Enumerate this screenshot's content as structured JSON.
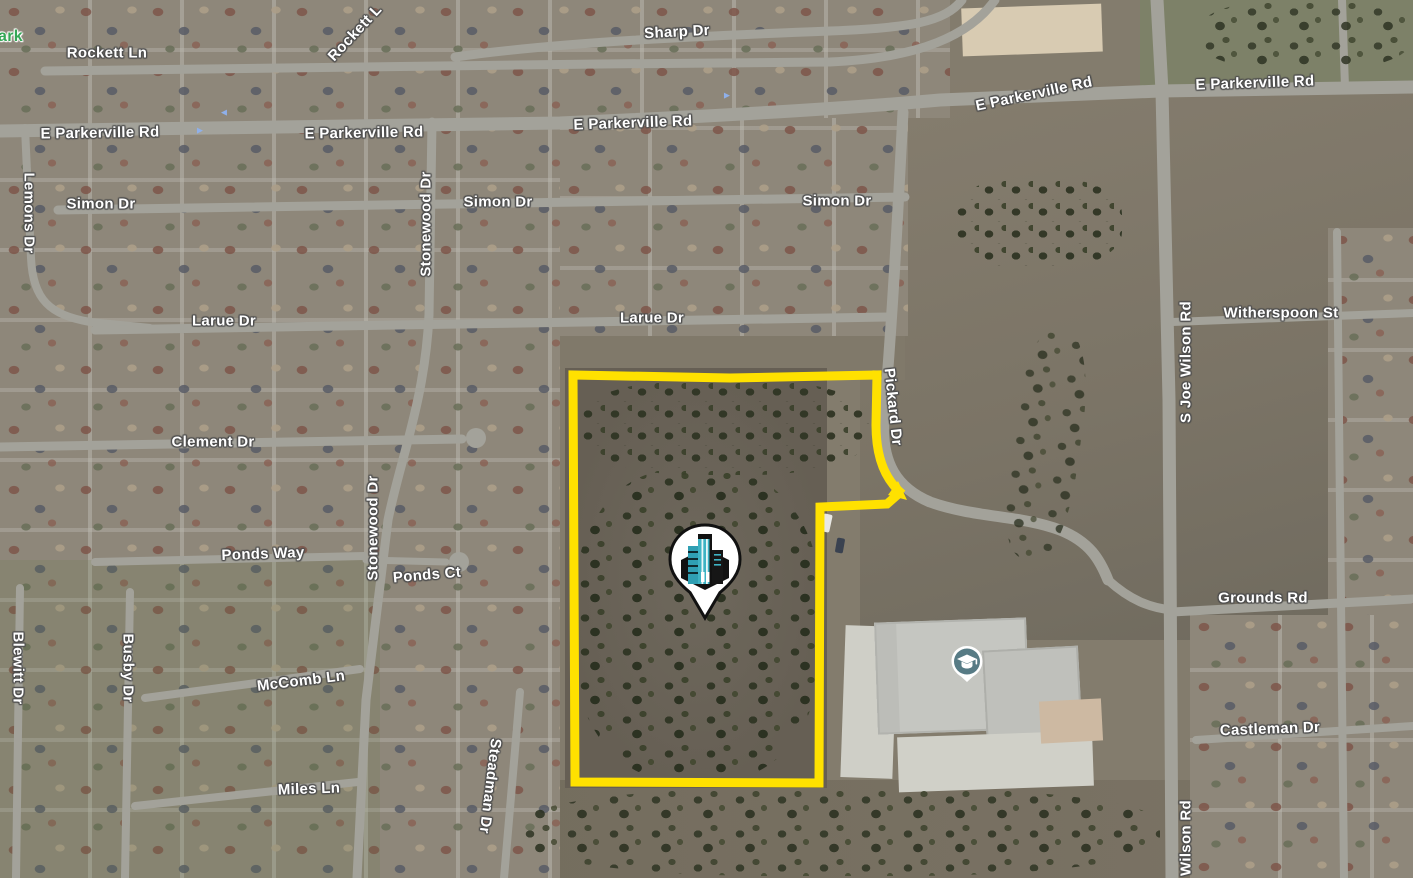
{
  "map": {
    "view_type": "satellite",
    "overlay_colors": {
      "property_boundary": "#FFE100",
      "park_label_green": "#34A757",
      "marker_logo_teal": "#3EB3C4",
      "school_poi_fill": "#577B85",
      "traffic_arrow_blue": "#8FB0EA"
    }
  },
  "labels": {
    "park": "ark",
    "streets": [
      {
        "id": "rockett-ln",
        "label": "Rockett Ln"
      },
      {
        "id": "rockett-ln-curve",
        "label": "Rockett L"
      },
      {
        "id": "sharp-dr",
        "label": "Sharp Dr"
      },
      {
        "id": "e-parkerville-rd-1",
        "label": "E Parkerville Rd"
      },
      {
        "id": "e-parkerville-rd-2",
        "label": "E Parkerville Rd"
      },
      {
        "id": "e-parkerville-rd-3",
        "label": "E Parkerville Rd"
      },
      {
        "id": "e-parkerville-rd-4",
        "label": "E Parkerville Rd"
      },
      {
        "id": "e-parkerville-rd-5",
        "label": "E Parkerville Rd"
      },
      {
        "id": "lemons-dr",
        "label": "Lemons Dr"
      },
      {
        "id": "simon-dr-1",
        "label": "Simon Dr"
      },
      {
        "id": "simon-dr-2",
        "label": "Simon Dr"
      },
      {
        "id": "simon-dr-3",
        "label": "Simon Dr"
      },
      {
        "id": "stonewood-dr-1",
        "label": "Stonewood Dr"
      },
      {
        "id": "larue-dr-1",
        "label": "Larue Dr"
      },
      {
        "id": "larue-dr-2",
        "label": "Larue Dr"
      },
      {
        "id": "pickard-dr",
        "label": "Pickard Dr"
      },
      {
        "id": "s-joe-wilson-rd",
        "label": "S Joe Wilson Rd"
      },
      {
        "id": "witherspoon-st",
        "label": "Witherspoon St"
      },
      {
        "id": "clement-dr",
        "label": "Clement Dr"
      },
      {
        "id": "ponds-way",
        "label": "Ponds Way"
      },
      {
        "id": "stonewood-dr-2",
        "label": "Stonewood Dr"
      },
      {
        "id": "ponds-ct",
        "label": "Ponds Ct"
      },
      {
        "id": "blewitt-dr",
        "label": "Blewitt Dr"
      },
      {
        "id": "busby-dr",
        "label": "Busby Dr"
      },
      {
        "id": "mccomb-ln",
        "label": "McComb Ln"
      },
      {
        "id": "grounds-rd",
        "label": "Grounds Rd"
      },
      {
        "id": "castleman-dr",
        "label": "Castleman Dr"
      },
      {
        "id": "miles-ln",
        "label": "Miles Ln"
      },
      {
        "id": "steadman-dr",
        "label": "Steadman Dr"
      },
      {
        "id": "wilson-rd",
        "label": "Wilson Rd"
      }
    ]
  },
  "icons": {
    "traffic_arrow_left": "◄",
    "traffic_arrow_right": "►",
    "property_marker": "building-logo-pin",
    "school_poi": "graduation-cap"
  }
}
